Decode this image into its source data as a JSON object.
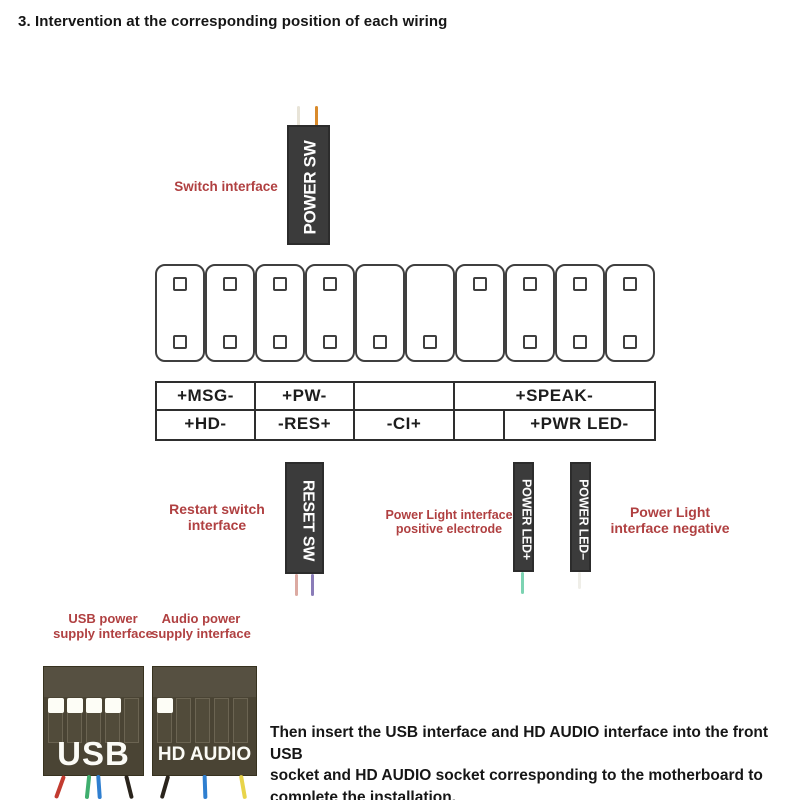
{
  "title": "3. Intervention at the corresponding position of each wiring",
  "connectors": {
    "power_sw": {
      "label": "POWER SW"
    },
    "reset_sw": {
      "label": "RESET SW"
    },
    "power_led_plus": {
      "label": "POWER LED+"
    },
    "power_led_minus": {
      "label": "POWER LED–"
    },
    "usb": {
      "label": "USB"
    },
    "hd_audio": {
      "label": "HD AUDIO"
    }
  },
  "annotations": {
    "switch_interface": "Switch interface",
    "restart_interface": {
      "line1": "Restart switch",
      "line2": "interface"
    },
    "power_light_positive": {
      "line1": "Power Light interface",
      "line2": "positive electrode"
    },
    "power_light_negative": {
      "line1": "Power Light",
      "line2": "interface negative"
    },
    "usb_power": {
      "line1": "USB power",
      "line2": "supply interface"
    },
    "audio_power": {
      "line1": "Audio power",
      "line2": "supply interface"
    }
  },
  "pin_header": {
    "pins": [
      {
        "top": true,
        "bottom": true
      },
      {
        "top": true,
        "bottom": true
      },
      {
        "top": true,
        "bottom": true
      },
      {
        "top": true,
        "bottom": true
      },
      {
        "top": false,
        "bottom": true
      },
      {
        "top": false,
        "bottom": true
      },
      {
        "top": true,
        "bottom": false
      },
      {
        "top": true,
        "bottom": true
      },
      {
        "top": true,
        "bottom": true
      },
      {
        "top": true,
        "bottom": true
      }
    ]
  },
  "pin_table": {
    "row1": [
      {
        "label": "+MSG-",
        "w": 99
      },
      {
        "label": "+PW-",
        "w": 99
      },
      {
        "label": "",
        "w": 100
      },
      {
        "label": "+SPEAK-",
        "w": 199
      }
    ],
    "row2": [
      {
        "label": "+HD-",
        "w": 99
      },
      {
        "label": "-RES+",
        "w": 99
      },
      {
        "label": "-CI+",
        "w": 100
      },
      {
        "label": "",
        "w": 50
      },
      {
        "label": "+PWR LED-",
        "w": 149
      }
    ]
  },
  "wires": {
    "power_sw_left": "#e8e4d8",
    "power_sw_right": "#d98a2b",
    "reset_sw_left": "#dcaaa2",
    "reset_sw_right": "#8a7cb8",
    "power_led_plus": "#7cd3b2",
    "power_led_minus": "#efeee8",
    "usb_1": "#c23b30",
    "usb_2": "#3fae6e",
    "usb_3": "#2f7fd0",
    "usb_4": "#2a241c",
    "hda_1": "#2a241c",
    "hda_2": "#2f7fd0",
    "hda_3": "#e8d44a"
  },
  "usb_slots": [
    true,
    true,
    true,
    true,
    false
  ],
  "hd_audio_slots": [
    true,
    false,
    false,
    false,
    false
  ],
  "footer": {
    "lines": [
      "Then insert the USB interface and HD AUDIO interface into the front USB",
      "socket and HD AUDIO socket corresponding to the motherboard to",
      "complete the installation."
    ]
  },
  "colors": {
    "label_red": "#b04041",
    "connector_dark": "#3b3b3b",
    "block_brown": "#4a4434",
    "text_dark": "#161616"
  }
}
